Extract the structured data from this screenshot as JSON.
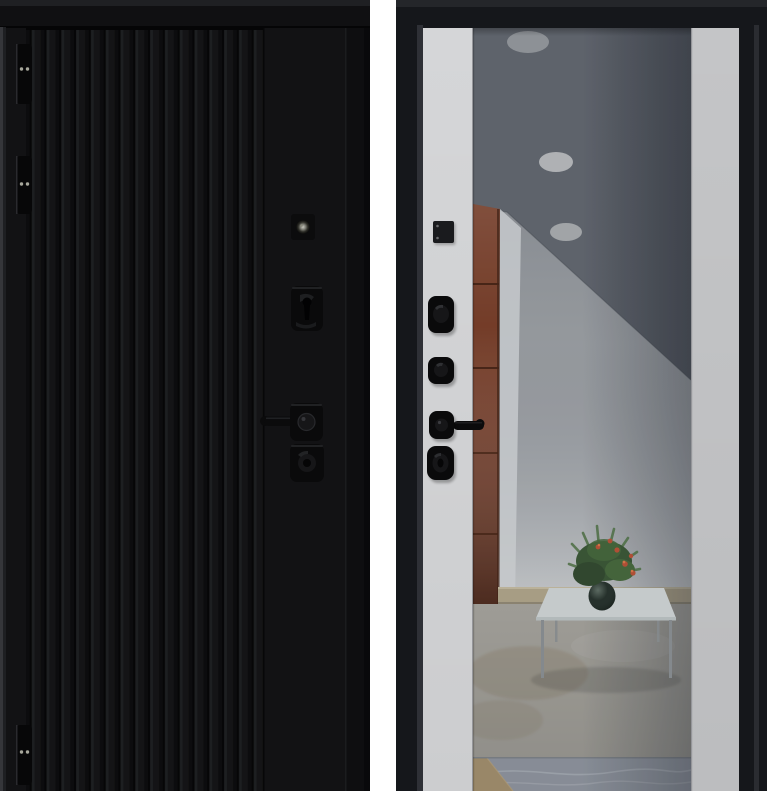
{
  "image": {
    "kind": "product-photo",
    "subject": "steel entry door, two views side by side",
    "panels": [
      {
        "id": "exterior",
        "label": "exterior side: black fluted panel, black hardware, three hinges, peephole"
      },
      {
        "id": "interior",
        "label": "interior side: black frame, white trim strips, full-height mirror"
      }
    ]
  },
  "scene": {
    "exterior": {
      "hinge_count": 3,
      "hardware": [
        "hinge",
        "hinge",
        "hinge",
        "peephole",
        "deadbolt-escutcheon",
        "lever-handle",
        "cylinder-escutcheon"
      ]
    },
    "interior": {
      "hardware": [
        "thumbturn-plate",
        "night-latch-knob",
        "lock-escutcheon",
        "lever-handle",
        "cylinder-knob"
      ],
      "mirror_reflection": [
        "ceiling-spotlights",
        "red-brown-cabinet",
        "white-coffee-table",
        "potted-plant",
        "beige-baseboard",
        "stone-floor",
        "marble-threshold"
      ],
      "spotlight_count": 3
    }
  },
  "colors": {
    "background_white": "#ffffff",
    "door_face": "#121214",
    "door_top_band": "#101012",
    "door_top_cap": "#1f2023",
    "door_edge_light": "#35363a",
    "door_edge_mid": "#1e1f22",
    "door_rebate": "#0e0e10",
    "door_rebate_dark": "#09090b",
    "stile_seam": "#070708",
    "hinge_black": "#070708",
    "screw_light": "#a6a69b",
    "hardware_black": "#0a0a0b",
    "hardware_boss": "#161618",
    "lever_black": "#0b0b0c",
    "peephole_ring": "#8a8a7c",
    "frame_black": "#15171b",
    "frame_cap": "#24262a",
    "frame_bevel_left": "#2e3036",
    "frame_bevel_right": "#2a2c31",
    "strip_left": "#d5d6d8",
    "strip_right": "#c4c5c7",
    "strip_edge": "#95969a",
    "mirror_wall": "#9a9da1",
    "mirror_ceiling": "#5c6068",
    "side_wall": "#cdcfd1",
    "spotlight_1": "#8f9296",
    "spotlight_2": "#b3b5b7",
    "spotlight_3": "#a4a7a9",
    "cabinet": "#73361f",
    "cabinet_seam": "#3a1809",
    "baseboard": "#ab9f83",
    "baseboard_line": "#837b68",
    "floor": "#a19e96",
    "floor_stain": "#84755c",
    "marble": "#888d96",
    "marble_vein": "#b6bac0",
    "marble_tan": "#9c8764",
    "table_top": "#cbd0d0",
    "table_edge": "#b7bdbd",
    "table_leg": "#85898c",
    "pot": "#131d17",
    "plant_dark": "#2b4226",
    "plant_mid": "#33502d",
    "plant_light": "#3f6134",
    "leaf_stroke": "#486b3c",
    "flower": "#b44a2e",
    "flower_light": "#d5713f"
  }
}
